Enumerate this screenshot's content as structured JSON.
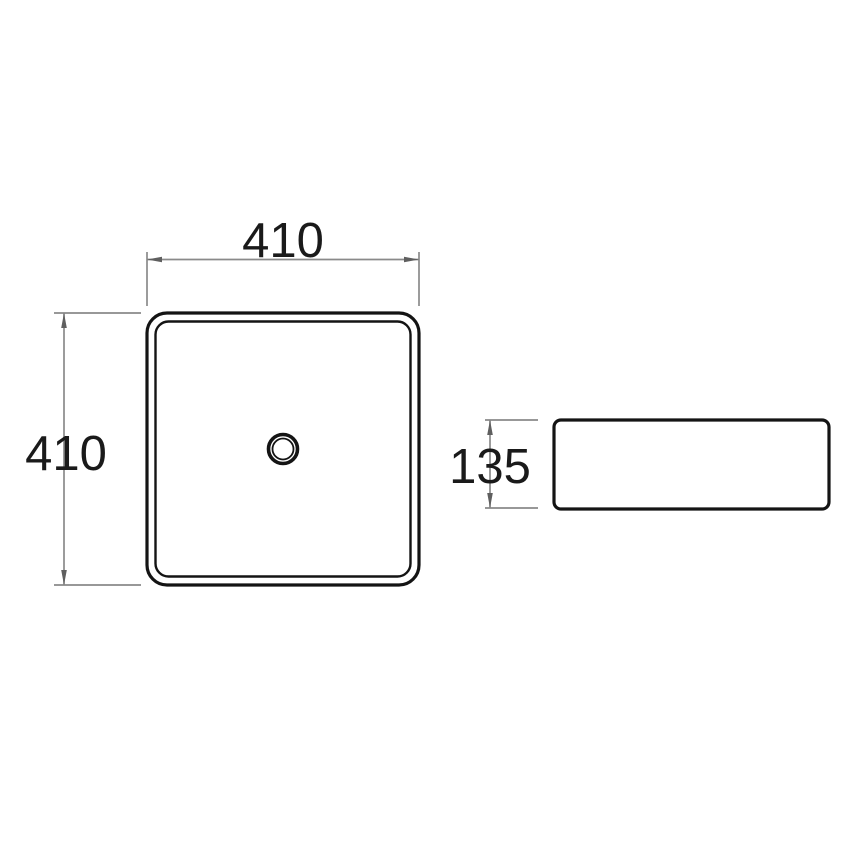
{
  "drawing": {
    "dimensions": {
      "plan_width": {
        "value": "410"
      },
      "plan_height": {
        "value": "410"
      },
      "side_height": {
        "value": "135"
      }
    },
    "colors": {
      "background": "#ffffff",
      "object_line": "#141414",
      "dimension_line": "#8a8a8a",
      "arrowhead": "#5f5f5f",
      "label_text": "#1a1a1a"
    }
  }
}
